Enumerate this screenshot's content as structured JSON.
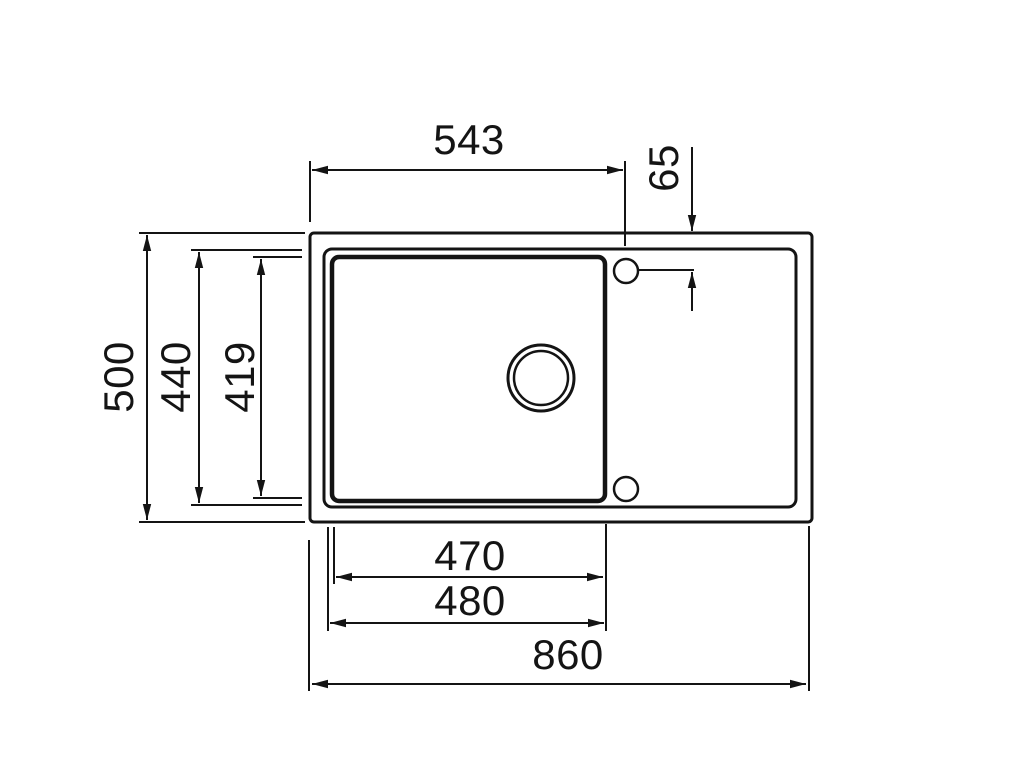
{
  "diagram": {
    "type": "technical-dimension-drawing",
    "subject": "kitchen sink top view with single basin, drainboard, drain hole and two tap holes",
    "line_color": "#141414",
    "background_color": "#ffffff",
    "dimensions": {
      "top_width": "543",
      "tap_hole_offset": "65",
      "overall_depth": "500",
      "rim_depth": "440",
      "basin_depth": "419",
      "basin_width_inner": "470",
      "basin_width_outer": "480",
      "overall_width": "860"
    }
  }
}
